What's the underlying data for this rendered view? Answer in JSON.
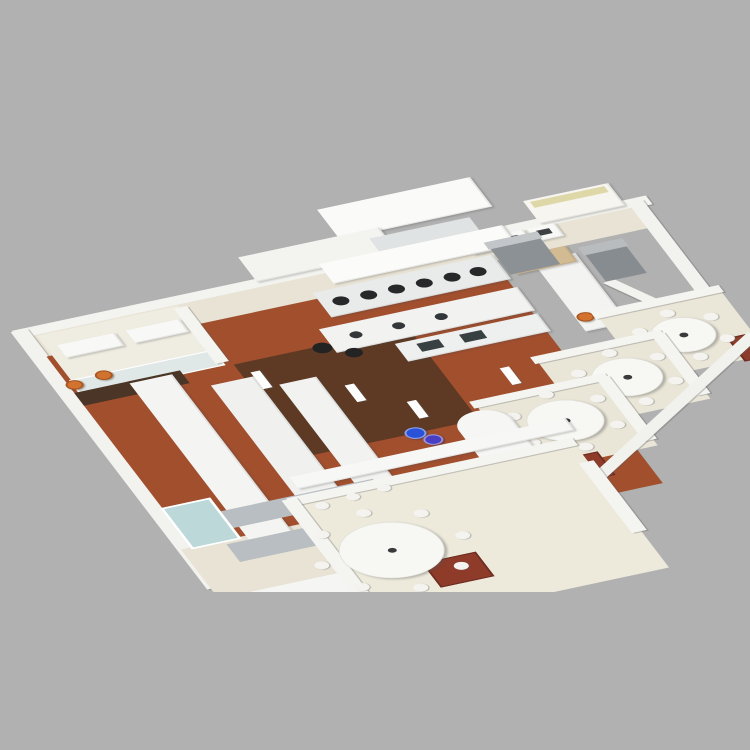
{
  "description": "3D isometric rendering of a commercial restaurant kitchen floor plan on a plain gray background, clipped at the bottom edge of the render",
  "background_color": "#b1b1b1",
  "palette": {
    "wall_white": "#f3f3f0",
    "equipment_white": "#f8f8f6",
    "stainless": "#e9ebeb",
    "terracotta_tile": "#a24f2e",
    "dark_wood": "#5e3a24",
    "cream_floor": "#e8e3d4",
    "dining_cream": "#edeadc",
    "teal_glass": "#8fd0c6",
    "blue_glass": "#bcd8d8",
    "orange_stool": "#d2722f",
    "red_mat": "#8e3b2a",
    "blue_bin": "#2a52d8",
    "wood_table": "#d2bb92"
  },
  "scene": {
    "objects": [
      {
        "name": "back-wall",
        "cls": "wall panels",
        "rect": [
          -14,
          -14,
          684,
          18
        ],
        "color": "#f3f3f0"
      },
      {
        "name": "service-corridor-floor",
        "rect": [
          0,
          2,
          656,
          42
        ],
        "color": "#e8e3d4"
      },
      {
        "name": "exhaust-hood-tower-1",
        "cls": "slab",
        "rect": [
          355,
          -112,
          165,
          60
        ],
        "color": "#fafaf8"
      },
      {
        "name": "exhaust-hood-tower-2",
        "cls": "slab",
        "rect": [
          248,
          -58,
          152,
          50
        ],
        "color": "#f3f3f0"
      },
      {
        "name": "back-pass-shelf",
        "cls": "cabinet",
        "rect": [
          383,
          -42,
          108,
          40
        ],
        "color": "#e0e3e3"
      },
      {
        "name": "display-counter",
        "cls": "slab",
        "rect": [
          552,
          -50,
          92,
          46
        ],
        "color": "#f6f5ef"
      },
      {
        "name": "display-glass-strip",
        "rect": [
          558,
          -46,
          80,
          12
        ],
        "color": "#ded8a8"
      },
      {
        "name": "back-equipment-box-1",
        "cls": "slab",
        "rect": [
          468,
          0,
          30,
          26
        ],
        "color": "#f8f8f6"
      },
      {
        "name": "back-equipment-box-2",
        "cls": "slab",
        "rect": [
          502,
          0,
          30,
          26
        ],
        "color": "#f8f8f6"
      },
      {
        "name": "back-equipment-box-3",
        "cls": "slab",
        "rect": [
          536,
          0,
          30,
          26
        ],
        "color": "#f8f8f6"
      },
      {
        "name": "equipment-control-panel-1",
        "rect": [
          475,
          7,
          14,
          10
        ],
        "color": "#3c4043"
      },
      {
        "name": "equipment-control-panel-2",
        "rect": [
          509,
          7,
          14,
          10
        ],
        "color": "#3c4043"
      },
      {
        "name": "equipment-control-panel-3",
        "rect": [
          543,
          7,
          14,
          10
        ],
        "color": "#3c4043"
      },
      {
        "name": "right-end-wall",
        "cls": "wall",
        "rect": [
          648,
          -8,
          16,
          280
        ],
        "color": "#f2f2ef"
      },
      {
        "name": "left-wall",
        "cls": "wall",
        "rect": [
          -16,
          -12,
          18,
          524
        ],
        "color": "#f2f2ef"
      },
      {
        "name": "kitchen-tile-floor",
        "cls": "tiles",
        "rect": [
          0,
          44,
          482,
          452
        ],
        "color": "#a24f2e"
      },
      {
        "name": "kitchen-wood-floor",
        "cls": "planks",
        "rect": [
          168,
          128,
          188,
          188
        ],
        "color": "#5e3a24"
      },
      {
        "name": "back-left-corridor-floor",
        "rect": [
          -12,
          432,
          158,
          212
        ],
        "color": "#e8e3d4"
      },
      {
        "name": "office-floor",
        "rect": [
          6,
          4,
          152,
          112
        ],
        "color": "#efece1"
      },
      {
        "name": "office-table-1",
        "cls": "slab",
        "rect": [
          18,
          28,
          62,
          26
        ],
        "color": "#f8f8f6"
      },
      {
        "name": "office-table-2",
        "cls": "slab",
        "rect": [
          92,
          28,
          58,
          26
        ],
        "color": "#f8f8f6"
      },
      {
        "name": "office-window-wall",
        "cls": "window-grid",
        "rect": [
          4,
          94,
          156,
          32
        ],
        "color": "#dfe8e6"
      },
      {
        "name": "office-side-wall",
        "cls": "wall",
        "rect": [
          152,
          8,
          14,
          112
        ],
        "color": "#f4f4f1"
      },
      {
        "name": "coffee-counter",
        "rect": [
          0,
          118,
          114,
          26
        ],
        "color": "#4a3526"
      },
      {
        "name": "orange-stool-1",
        "cls": "stool",
        "cx": 6,
        "cy": 104,
        "d": 18,
        "color": "#d2722f"
      },
      {
        "name": "orange-stool-2",
        "cls": "stool",
        "cx": 40,
        "cy": 98,
        "d": 18,
        "color": "#d2722f"
      },
      {
        "name": "orange-stool-3",
        "cls": "stool",
        "cx": 148,
        "cy": 214,
        "d": 18,
        "color": "#d2722f"
      },
      {
        "name": "prep-counter-long-1",
        "cls": "slab",
        "rect": [
          58,
          122,
          46,
          326
        ],
        "color": "#f4f4f2"
      },
      {
        "name": "prep-counter-long-2",
        "cls": "slab",
        "rect": [
          132,
          156,
          46,
          278
        ],
        "color": "#f0f0ee"
      },
      {
        "name": "prep-counter-long-3",
        "cls": "slab",
        "rect": [
          196,
          180,
          40,
          230
        ],
        "color": "#f2f2f0"
      },
      {
        "name": "hood-canopy",
        "cls": "slab",
        "rect": [
          318,
          -16,
          198,
          40
        ],
        "color": "#fbfbf9"
      },
      {
        "name": "wok-range-line",
        "cls": "slab",
        "rect": [
          292,
          32,
          194,
          50
        ],
        "color": "#e9ebeb"
      },
      {
        "name": "wok-burner-1",
        "cx": 312,
        "cy": 56,
        "d": 17,
        "color": "#26282a"
      },
      {
        "name": "wok-burner-2",
        "cx": 342,
        "cy": 56,
        "d": 17,
        "color": "#26282a"
      },
      {
        "name": "wok-burner-3",
        "cx": 372,
        "cy": 56,
        "d": 17,
        "color": "#26282a"
      },
      {
        "name": "wok-burner-4",
        "cx": 402,
        "cy": 56,
        "d": 17,
        "color": "#26282a"
      },
      {
        "name": "wok-burner-5",
        "cx": 432,
        "cy": 56,
        "d": 17,
        "color": "#26282a"
      },
      {
        "name": "wok-burner-6",
        "cx": 460,
        "cy": 56,
        "d": 17,
        "color": "#26282a"
      },
      {
        "name": "cook-island",
        "cls": "slab",
        "rect": [
          272,
          98,
          214,
          48
        ],
        "color": "#f2f2f0"
      },
      {
        "name": "fryer-well-1",
        "cx": 302,
        "cy": 121,
        "d": 13,
        "color": "#33373a"
      },
      {
        "name": "fryer-well-2",
        "cx": 348,
        "cy": 121,
        "d": 13,
        "color": "#33373a"
      },
      {
        "name": "fryer-well-3",
        "cx": 394,
        "cy": 121,
        "d": 13,
        "color": "#33373a"
      },
      {
        "name": "sink-counter",
        "cls": "slab",
        "rect": [
          332,
          152,
          154,
          36
        ],
        "color": "#eef0ef"
      },
      {
        "name": "sink-basin-1",
        "rect": [
          352,
          160,
          24,
          16
        ],
        "color": "#384042"
      },
      {
        "name": "sink-basin-2",
        "rect": [
          398,
          160,
          24,
          16
        ],
        "color": "#384042"
      },
      {
        "name": "stock-pot-1",
        "cx": 262,
        "cy": 132,
        "d": 20,
        "color": "#232323"
      },
      {
        "name": "stock-pot-2",
        "cx": 288,
        "cy": 152,
        "d": 18,
        "color": "#232323"
      },
      {
        "name": "prep-counter-right",
        "cls": "slab",
        "rect": [
          518,
          60,
          46,
          142
        ],
        "color": "#f3f3f1"
      },
      {
        "name": "wood-prep-table",
        "cls": "slab",
        "rect": [
          494,
          44,
          66,
          32
        ],
        "color": "#d2bb92"
      },
      {
        "name": "wing-partition-wall",
        "cls": "wall",
        "rect": [
          580,
          118,
          164,
          13
        ],
        "rotate": 63,
        "color": "#f2f2ef"
      },
      {
        "name": "upright-fridge-right",
        "rect": [
          572,
          62,
          44,
          60
        ],
        "color": "#878c90"
      },
      {
        "name": "upright-fridge-right-top",
        "rect": [
          570,
          52,
          48,
          16
        ],
        "color": "#b8bcbf"
      },
      {
        "name": "upright-fridge-center",
        "rect": [
          488,
          16,
          54,
          58
        ],
        "color": "#8b9195"
      },
      {
        "name": "upright-fridge-center-top",
        "rect": [
          486,
          8,
          58,
          14
        ],
        "color": "#c2c6c9"
      },
      {
        "name": "teal-glass-door",
        "cls": "glass",
        "rect": [
          470,
          240,
          40,
          60
        ],
        "color": "#8fd0c6"
      },
      {
        "name": "wing-corridor-counter",
        "cls": "slab",
        "rect": [
          560,
          186,
          82,
          32
        ],
        "color": "#f7f7f5"
      },
      {
        "name": "orange-stool-4",
        "cls": "stool",
        "cx": 528,
        "cy": 176,
        "d": 18,
        "color": "#d2722f"
      },
      {
        "name": "orange-stool-5",
        "cls": "stool",
        "cx": 556,
        "cy": 198,
        "d": 18,
        "color": "#d2722f"
      },
      {
        "name": "private-room-1-floor",
        "cls": "ribbed",
        "rect": [
          540,
          178,
          132,
          132
        ],
        "color": "#eae6d8"
      },
      {
        "name": "private-room-1-wall",
        "cls": "wall ribbed",
        "rect": [
          536,
          170,
          138,
          14
        ],
        "color": "#f4f4f1"
      },
      {
        "name": "private-room-1-mat",
        "cls": "mat",
        "rect": [
          644,
          266,
          44,
          48
        ],
        "color": "#8e3b2a"
      },
      {
        "name": "private-room-1-table",
        "type": "round-table",
        "cx": 606,
        "cy": 244,
        "d": 66,
        "chairs": 6,
        "chairR": 44,
        "color": "#f7f7f4"
      },
      {
        "name": "private-room-2-floor",
        "cls": "ribbed",
        "rect": [
          452,
          232,
          134,
          134
        ],
        "color": "#e9e5d7"
      },
      {
        "name": "private-room-2-wall",
        "cls": "wall ribbed",
        "rect": [
          448,
          226,
          140,
          14
        ],
        "color": "#f4f4f1"
      },
      {
        "name": "private-room-2-divider",
        "cls": "wall",
        "rect": [
          576,
          232,
          14,
          124
        ],
        "color": "#f4f4f1"
      },
      {
        "name": "private-room-2-table",
        "type": "round-table",
        "cx": 524,
        "cy": 297,
        "d": 72,
        "chairs": 6,
        "chairR": 49,
        "color": "#f7f7f4"
      },
      {
        "name": "private-room-3-floor",
        "cls": "ribbed",
        "rect": [
          364,
          288,
          140,
          140
        ],
        "color": "#e9e5d7"
      },
      {
        "name": "private-room-3-wall",
        "cls": "wall ribbed",
        "rect": [
          360,
          281,
          146,
          14
        ],
        "color": "#f4f4f1"
      },
      {
        "name": "private-room-3-divider",
        "cls": "wall",
        "rect": [
          494,
          288,
          14,
          128
        ],
        "color": "#f4f4f1"
      },
      {
        "name": "private-room-3-mat",
        "cls": "mat",
        "rect": [
          396,
          416,
          48,
          48
        ],
        "color": "#8e3b2a"
      },
      {
        "name": "private-room-3-table",
        "type": "round-table",
        "cx": 436,
        "cy": 350,
        "d": 78,
        "chairs": 6,
        "chairR": 53,
        "color": "#f7f7f4"
      },
      {
        "name": "wing-outer-wall",
        "cls": "wall",
        "rect": [
          370,
          496,
          378,
          15
        ],
        "rotate": -38,
        "color": "#f1f1ee"
      },
      {
        "name": "blue-bin-1",
        "cls": "bin",
        "cx": 288,
        "cy": 316,
        "d": 22,
        "color": "#2a52d8"
      },
      {
        "name": "blue-bin-2",
        "cls": "bin",
        "cx": 300,
        "cy": 334,
        "d": 20,
        "color": "#4a3ec2"
      },
      {
        "name": "service-bar-counter",
        "cls": "slab round-end",
        "rect": [
          330,
          300,
          58,
          152
        ],
        "color": "#f6f6f4"
      },
      {
        "name": "teal-glass-panel",
        "cls": "glass",
        "rect": [
          373,
          388,
          24,
          30
        ],
        "color": "#7fc8bc"
      },
      {
        "name": "wire-shelving-rack-1",
        "cls": "hatch",
        "rect": [
          42,
          380,
          174,
          34
        ],
        "color": "#b9bec2"
      },
      {
        "name": "wire-shelving-rack-2",
        "cls": "hatch",
        "rect": [
          34,
          440,
          166,
          36
        ],
        "color": "#b9bec2"
      },
      {
        "name": "blue-glass-partition",
        "cls": "glass-grid",
        "rect": [
          -2,
          352,
          54,
          84
        ],
        "color": "#bcd8d8"
      },
      {
        "name": "storage-cabinet-row",
        "cls": "cabinet slab",
        "rect": [
          12,
          532,
          112,
          58
        ],
        "color": "#f5f5f3"
      },
      {
        "name": "dining-pass-counter",
        "cls": "slab",
        "rect": [
          140,
          346,
          298,
          24
        ],
        "color": "#f7f7f5"
      },
      {
        "name": "dining-room-floor",
        "rect": [
          126,
          390,
          302,
          256
        ],
        "color": "#edeadc"
      },
      {
        "name": "dining-room-top-wall",
        "cls": "wall ribbed",
        "rect": [
          122,
          382,
          308,
          16
        ],
        "color": "#f4f4f1"
      },
      {
        "name": "dining-room-left-wall",
        "cls": "wall",
        "rect": [
          116,
          384,
          16,
          268
        ],
        "color": "#f4f4f1"
      },
      {
        "name": "dining-room-right-wall",
        "cls": "wall",
        "rect": [
          418,
          430,
          16,
          142
        ],
        "color": "#f4f4f1"
      },
      {
        "name": "dining-room-mat",
        "cls": "mat",
        "rect": [
          202,
          546,
          58,
          50
        ],
        "color": "#8e3b2a"
      },
      {
        "name": "dining-stray-chair-1",
        "cls": "chair round",
        "cx": 150,
        "cy": 408,
        "d": 14,
        "color": "#f4f3ef"
      },
      {
        "name": "dining-stray-chair-2",
        "cls": "chair round",
        "cx": 185,
        "cy": 404,
        "d": 14,
        "color": "#f4f3ef"
      },
      {
        "name": "dining-stray-chair-3",
        "cls": "chair round",
        "cx": 220,
        "cy": 400,
        "d": 14,
        "color": "#f4f3ef"
      },
      {
        "name": "dining-round-table",
        "type": "round-table",
        "cx": 183,
        "cy": 512,
        "d": 106,
        "chairs": 8,
        "chairR": 76,
        "color": "#f7f7f4"
      },
      {
        "name": "pillar-1",
        "cls": "wall",
        "rect": [
          178,
          148,
          10,
          34
        ],
        "color": "#fdfdfd"
      },
      {
        "name": "pillar-2",
        "cls": "wall",
        "rect": [
          256,
          206,
          10,
          34
        ],
        "color": "#fdfdfd"
      },
      {
        "name": "pillar-3",
        "cls": "wall",
        "rect": [
          302,
          258,
          10,
          34
        ],
        "color": "#fdfdfd"
      },
      {
        "name": "pillar-4",
        "cls": "wall",
        "rect": [
          412,
          234,
          10,
          34
        ],
        "color": "#fdfdfd"
      }
    ]
  }
}
